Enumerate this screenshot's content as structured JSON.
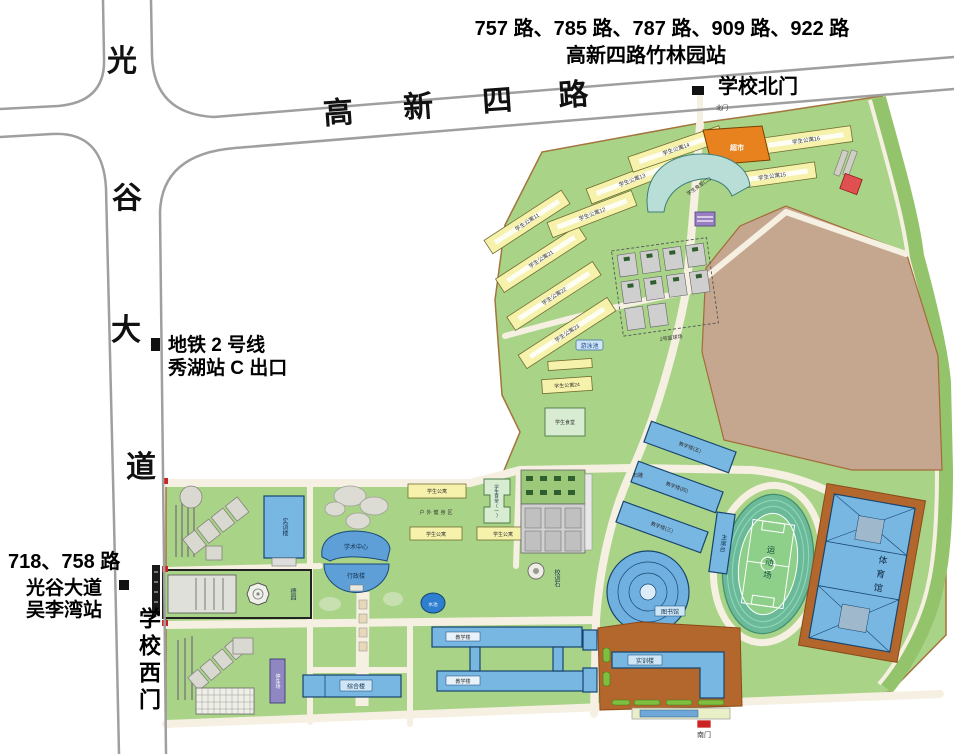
{
  "annotations": {
    "bus_north_line1": "757 路、785 路、787 路、909 路、922 路",
    "bus_north_line2": "高新四路竹林园站",
    "gate_north": "学校北门",
    "gate_north_small": "北门",
    "metro_line1": "地铁 2 号线",
    "metro_line2": "秀湖站 C 出口",
    "bus_west_line1": "718、758 路",
    "bus_west_line2": "光谷大道",
    "bus_west_line3": "吴李湾站",
    "gate_west": "学校西门",
    "gate_south": "南门"
  },
  "roads": {
    "vertical_name": "光谷大道",
    "vertical_chars": [
      "光",
      "谷",
      "大",
      "道"
    ],
    "horizontal_name": "高新四路",
    "horizontal_chars": [
      "高",
      "新",
      "四",
      "路"
    ]
  },
  "campus": {
    "dorms": {
      "d11": "学生公寓11",
      "d12": "学生公寓12",
      "d13": "学生公寓13",
      "d14": "学生公寓14",
      "d15": "学生公寓15",
      "d16": "学生公寓16",
      "d21": "学生公寓21",
      "d22": "学生公寓22",
      "d23": "学生公寓23",
      "d24": "学生公寓24",
      "generic": "学生公寓"
    },
    "facilities": {
      "supermarket": "超市",
      "canteen2": "学生食堂(二)",
      "canteen1": "学生食堂(一)",
      "canteen": "学生食堂",
      "basketball": "2号篮球场",
      "pool": "游泳池",
      "fitness": "户外健身区",
      "academic": "学术中心",
      "admin": "行政楼",
      "training_west": "实训楼",
      "garden": "德园",
      "pond": "水池",
      "motto_stone": "校训石",
      "stone_sculpture": "石雕",
      "teaching": "教学楼",
      "teaching3": "教学楼(三)",
      "teaching4": "教学楼(四)",
      "teaching5": "教学楼(五)",
      "rostrum": "主席台",
      "sports_field": "运动场",
      "gymnasium": "体育馆",
      "library": "图书馆",
      "training_se": "实训楼",
      "complex_bldg": "综合楼",
      "parking": "停车场"
    },
    "colors": {
      "grass": "#a9d387",
      "field_brown": "#c5a78f",
      "building_blue": "#79b7e3",
      "dorm_yellow": "#f6f2ac",
      "supermarket_orange": "#e8821e",
      "pad_brown": "#b4672c"
    }
  }
}
